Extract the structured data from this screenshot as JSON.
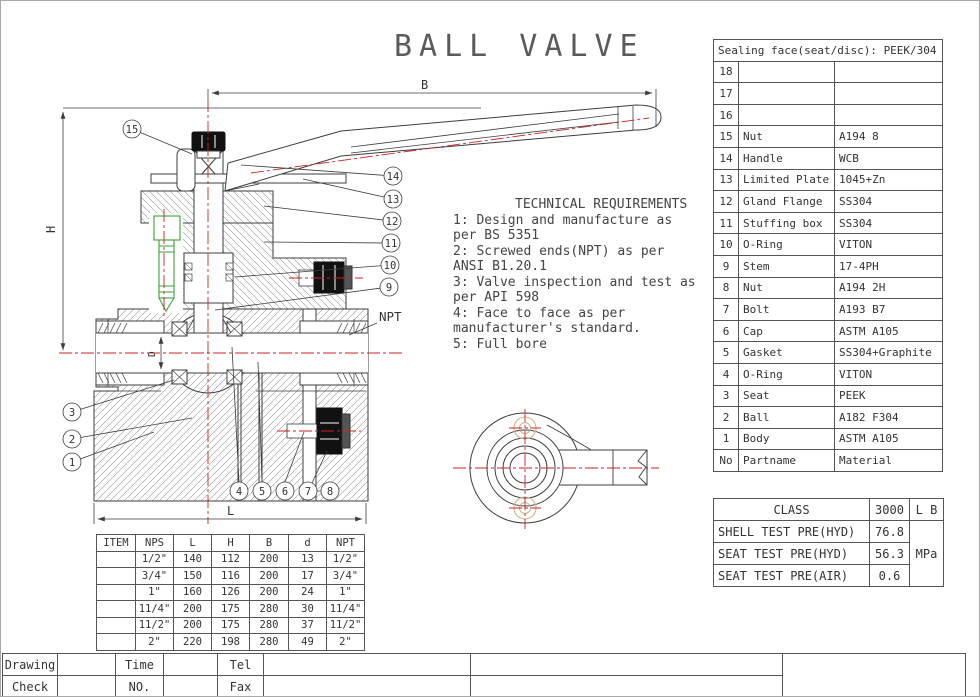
{
  "title": "BALL  VALVE",
  "tech": {
    "heading": "TECHNICAL REQUIREMENTS",
    "lines": [
      "1: Design and manufacture as",
      "per BS 5351",
      "2: Screwed ends(NPT) as per",
      "ANSI B1.20.1",
      "3: Valve inspection and test as",
      "per API 598",
      "4: Face to face as per",
      "manufacturer's standard.",
      "5: Full bore"
    ]
  },
  "dim_labels": {
    "b": "B",
    "h": "H",
    "l": "L",
    "d": "D",
    "npt": "NPT"
  },
  "balloons": {
    "b1": "1",
    "b2": "2",
    "b3": "3",
    "b4": "4",
    "b5": "5",
    "b6": "6",
    "b7": "7",
    "b8": "8",
    "b9": "9",
    "b10": "10",
    "b11": "11",
    "b12": "12",
    "b13": "13",
    "b14": "14",
    "b15": "15"
  },
  "parts_table": {
    "header_note": "Sealing face(seat/disc): PEEK/304",
    "rows": [
      {
        "no": "18",
        "name": "",
        "material": ""
      },
      {
        "no": "17",
        "name": "",
        "material": ""
      },
      {
        "no": "16",
        "name": "",
        "material": ""
      },
      {
        "no": "15",
        "name": "Nut",
        "material": "A194 8"
      },
      {
        "no": "14",
        "name": "Handle",
        "material": "WCB"
      },
      {
        "no": "13",
        "name": "Limited Plate",
        "material": "1045+Zn"
      },
      {
        "no": "12",
        "name": "Gland Flange",
        "material": "SS304"
      },
      {
        "no": "11",
        "name": "Stuffing box",
        "material": "SS304"
      },
      {
        "no": "10",
        "name": "O-Ring",
        "material": "VITON"
      },
      {
        "no": "9",
        "name": "Stem",
        "material": "17-4PH"
      },
      {
        "no": "8",
        "name": "Nut",
        "material": "A194 2H"
      },
      {
        "no": "7",
        "name": "Bolt",
        "material": "A193 B7"
      },
      {
        "no": "6",
        "name": "Cap",
        "material": "ASTM A105"
      },
      {
        "no": "5",
        "name": "Gasket",
        "material": "SS304+Graphite"
      },
      {
        "no": "4",
        "name": "O-Ring",
        "material": "VITON"
      },
      {
        "no": "3",
        "name": "Seat",
        "material": "PEEK"
      },
      {
        "no": "2",
        "name": "Ball",
        "material": "A182 F304"
      },
      {
        "no": "1",
        "name": "Body",
        "material": "ASTM A105"
      }
    ],
    "footer": {
      "no": "No",
      "name": "Partname",
      "material": "Material"
    }
  },
  "class_table": {
    "rows": [
      {
        "label": "CLASS",
        "value": "3000",
        "unit": "L B"
      },
      {
        "label": "SHELL TEST PRE(HYD)",
        "value": "76.8"
      },
      {
        "label": "SEAT TEST PRE(HYD)",
        "value": "56.3"
      },
      {
        "label": "SEAT TEST PRE(AIR)",
        "value": "0.6"
      }
    ],
    "unit_merged": "MPa"
  },
  "dims_table": {
    "headers": [
      "ITEM",
      "NPS",
      "L",
      "H",
      "B",
      "d",
      "NPT"
    ],
    "rows": [
      [
        "",
        "1/2\"",
        "140",
        "112",
        "200",
        "13",
        "1/2\""
      ],
      [
        "",
        "3/4\"",
        "150",
        "116",
        "200",
        "17",
        "3/4\""
      ],
      [
        "",
        "1\"",
        "160",
        "126",
        "200",
        "24",
        "1\""
      ],
      [
        "",
        "11/4\"",
        "200",
        "175",
        "280",
        "30",
        "11/4\""
      ],
      [
        "",
        "11/2\"",
        "200",
        "175",
        "280",
        "37",
        "11/2\""
      ],
      [
        "",
        "2\"",
        "220",
        "198",
        "280",
        "49",
        "2\""
      ]
    ]
  },
  "title_block": {
    "drawing": "Drawing",
    "check": "Check",
    "time": "Time",
    "no": "NO.",
    "tel": "Tel",
    "fax": "Fax"
  },
  "colors": {
    "line": "#3d3d3d",
    "centerline_red": "#cc2222",
    "bolt_green": "#3aa33a",
    "phantom_tan": "#c9b489",
    "table_border": "#555555"
  }
}
